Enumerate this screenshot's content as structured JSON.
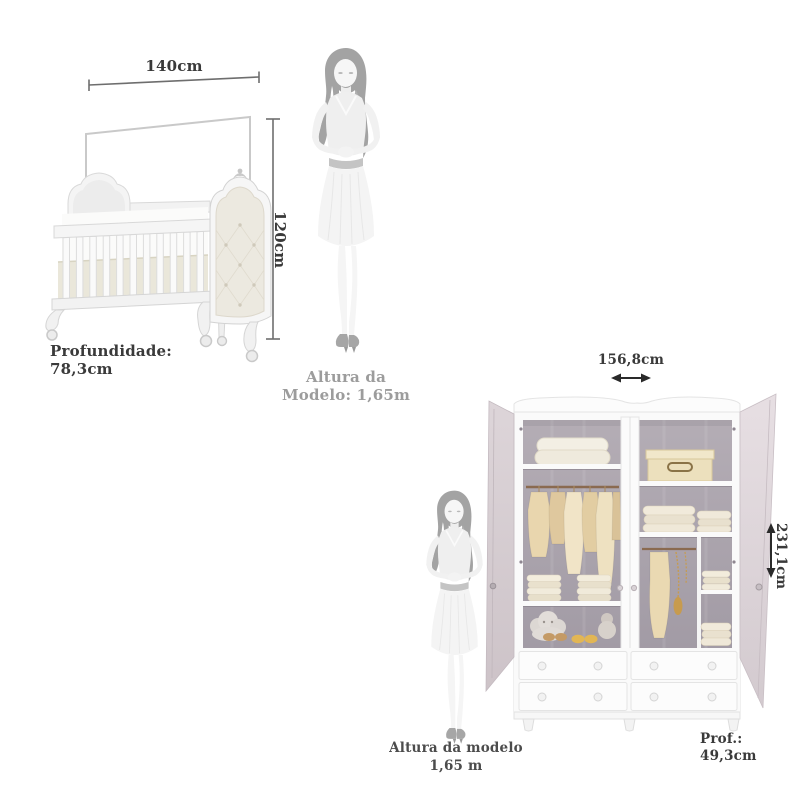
{
  "crib": {
    "width_label": "140cm",
    "height_label": "120cm",
    "depth": {
      "label": "Profundidade:",
      "value": "78,3cm"
    }
  },
  "model_top": {
    "line1": "Altura da",
    "line2": "Modelo: 1,65m"
  },
  "wardrobe": {
    "width_label": "156,8cm",
    "height_label": "231,1cm",
    "depth": {
      "label": "Prof.:",
      "value": "49,3cm"
    }
  },
  "model_bottom": {
    "line1": "Altura da modelo",
    "line2": "1,65 m"
  },
  "colors": {
    "background": "#ffffff",
    "dimension_text": "#3a3a3a",
    "model_caption_gray": "#9c9c9c",
    "model_caption_dark": "#4c4c4c",
    "furniture_white": "#f5f5f5",
    "wardrobe_interior": "#a8a1aa",
    "door_inner_pink": "#d6ccd1",
    "clothes_beige": "#e8d5ad",
    "mattress_ivory": "#eae7da",
    "silhouette_body": "#efefef",
    "silhouette_hair": "#a3a3a3"
  }
}
